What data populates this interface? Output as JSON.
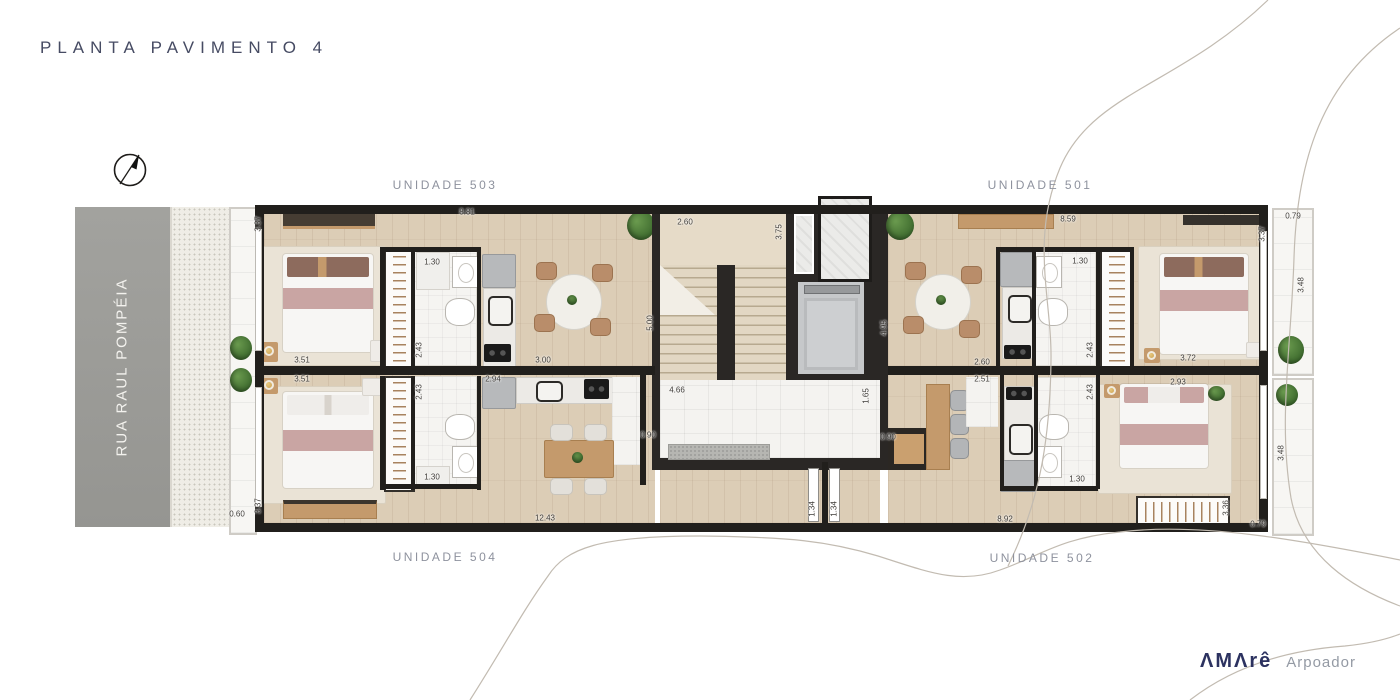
{
  "header": {
    "title": "PLANTA PAVIMENTO 4"
  },
  "street": {
    "name": "RUA RAUL POMPÉIA"
  },
  "units": [
    {
      "number": "503",
      "label": "UNIDADE 503",
      "x": 445,
      "y": 185
    },
    {
      "number": "501",
      "label": "UNIDADE 501",
      "x": 1040,
      "y": 185
    },
    {
      "number": "504",
      "label": "UNIDADE 504",
      "x": 445,
      "y": 557
    },
    {
      "number": "502",
      "label": "UNIDADE 502",
      "x": 1042,
      "y": 558
    }
  ],
  "dims": [
    {
      "t": "3.37",
      "x": 258,
      "y": 224,
      "o": "v"
    },
    {
      "t": "8.81",
      "x": 467,
      "y": 212,
      "o": "h"
    },
    {
      "t": "2.60",
      "x": 685,
      "y": 222,
      "o": "h"
    },
    {
      "t": "3.75",
      "x": 779,
      "y": 232,
      "o": "v"
    },
    {
      "t": "8.59",
      "x": 1068,
      "y": 219,
      "o": "h"
    },
    {
      "t": "0.79",
      "x": 1293,
      "y": 216,
      "o": "h"
    },
    {
      "t": "3.37",
      "x": 1262,
      "y": 234,
      "o": "v"
    },
    {
      "t": "3.48",
      "x": 1301,
      "y": 285,
      "o": "v"
    },
    {
      "t": "1.30",
      "x": 432,
      "y": 262,
      "o": "h"
    },
    {
      "t": "1.30",
      "x": 1080,
      "y": 261,
      "o": "h"
    },
    {
      "t": "2.43",
      "x": 419,
      "y": 350,
      "o": "v"
    },
    {
      "t": "2.43",
      "x": 1090,
      "y": 350,
      "o": "v"
    },
    {
      "t": "5.00",
      "x": 650,
      "y": 323,
      "o": "v"
    },
    {
      "t": "4.95",
      "x": 884,
      "y": 328,
      "o": "v"
    },
    {
      "t": "3.51",
      "x": 302,
      "y": 360,
      "o": "h"
    },
    {
      "t": "3.00",
      "x": 543,
      "y": 360,
      "o": "h"
    },
    {
      "t": "2.60",
      "x": 982,
      "y": 362,
      "o": "h"
    },
    {
      "t": "3.72",
      "x": 1188,
      "y": 358,
      "o": "h"
    },
    {
      "t": "3.51",
      "x": 302,
      "y": 379,
      "o": "h"
    },
    {
      "t": "2.94",
      "x": 493,
      "y": 379,
      "o": "h"
    },
    {
      "t": "2.51",
      "x": 982,
      "y": 379,
      "o": "h"
    },
    {
      "t": "2.93",
      "x": 1178,
      "y": 382,
      "o": "h"
    },
    {
      "t": "2.43",
      "x": 419,
      "y": 392,
      "o": "v"
    },
    {
      "t": "2.43",
      "x": 1090,
      "y": 392,
      "o": "v"
    },
    {
      "t": "4.66",
      "x": 677,
      "y": 390,
      "o": "h"
    },
    {
      "t": "1.65",
      "x": 866,
      "y": 396,
      "o": "v"
    },
    {
      "t": "0.90",
      "x": 648,
      "y": 435,
      "o": "h"
    },
    {
      "t": "0.90",
      "x": 888,
      "y": 437,
      "o": "h"
    },
    {
      "t": "1.30",
      "x": 432,
      "y": 477,
      "o": "h"
    },
    {
      "t": "1.30",
      "x": 1077,
      "y": 479,
      "o": "h"
    },
    {
      "t": "1.34",
      "x": 812,
      "y": 509,
      "o": "v"
    },
    {
      "t": "1.34",
      "x": 834,
      "y": 509,
      "o": "v"
    },
    {
      "t": "3.37",
      "x": 258,
      "y": 506,
      "o": "v"
    },
    {
      "t": "0.60",
      "x": 237,
      "y": 514,
      "o": "h"
    },
    {
      "t": "12.43",
      "x": 545,
      "y": 518,
      "o": "h"
    },
    {
      "t": "8.92",
      "x": 1005,
      "y": 519,
      "o": "h"
    },
    {
      "t": "3.36",
      "x": 1226,
      "y": 508,
      "o": "v"
    },
    {
      "t": "3.48",
      "x": 1281,
      "y": 453,
      "o": "v"
    },
    {
      "t": "0.79",
      "x": 1258,
      "y": 524,
      "o": "h"
    }
  ],
  "logo": {
    "brand": "ΛMΛrê",
    "sub": "Arpoador"
  },
  "colors": {
    "wall": "#211f1c",
    "wood_floor": "#dccdb6",
    "tile": "#f4f3f0",
    "title_navy": "#464b63",
    "label_gray": "#8e929e",
    "dim_text": "#3f3c38",
    "road_gray": "#9d9d99",
    "plant_green": "#4d7c3a",
    "throw_pink": "#c9a5a3",
    "brand_navy": "#2c3260",
    "wood_furniture": "#c49a6c"
  }
}
